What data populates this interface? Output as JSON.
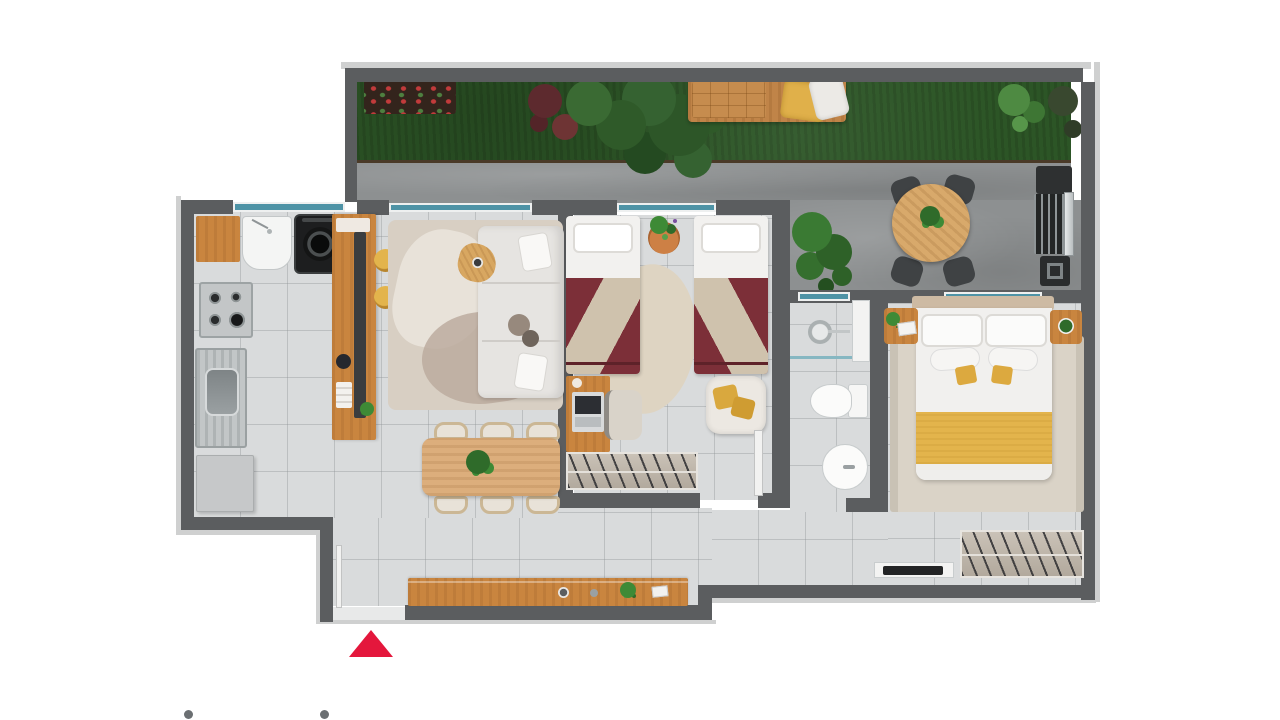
{
  "scene": {
    "type": "apartment-floor-plan-3d-render",
    "visible_text": [],
    "palette": {
      "background": "#ffffff",
      "wall": "#5b5d5f",
      "wall_trim": "#cfd0d0",
      "floor_tile": "#d9dbdc",
      "grass": "#2c5526",
      "concrete": "#8d9091",
      "window_glass": "#4e93a6",
      "wood": "#c9853f",
      "wood_light": "#dcae7c",
      "burgundy_bedding": "#7c2f38",
      "mustard_accent": "#e3b44c",
      "rug_beige": "#d8cfc3",
      "white_furniture": "#f2f1ef",
      "dark_appliance": "#232525",
      "steel": "#ccd0d1",
      "foliage_dark": "#2f5a29",
      "foliage_mid": "#3a6a33",
      "foliage_bright": "#4e8a42",
      "entrance_arrow_red": "#e4173c",
      "dot_gray": "#6b6f72"
    },
    "markers": {
      "entrance_arrow": {
        "shape": "triangle-up",
        "color": "#e4173c"
      },
      "pagination_dots": {
        "count": 2,
        "color": "#6b6f72"
      }
    },
    "rooms": [
      {
        "name": "garden",
        "items": [
          "flower-bed",
          "red-foliage",
          "tropical-plants",
          "daybed-bench",
          "yellow-throw",
          "pillows",
          "shrubs"
        ]
      },
      {
        "name": "terrace",
        "items": [
          "round-table",
          "chairs-x4",
          "table-plant",
          "potted-bush",
          "barbecue-grill"
        ]
      },
      {
        "name": "kitchen-laundry",
        "items": [
          "wall-shelf",
          "laundry-tub",
          "washing-machine",
          "cooktop",
          "sink-drainboard",
          "base-cabinet",
          "island-counter",
          "bar-stools-x2"
        ]
      },
      {
        "name": "living-dining",
        "items": [
          "area-rug",
          "sofa",
          "throw-pillows",
          "side-table",
          "dining-table",
          "dining-chairs-x6",
          "centerpiece-plant"
        ]
      },
      {
        "name": "twin-bedroom",
        "items": [
          "single-bed-left",
          "single-bed-right",
          "plant-pot",
          "oval-rug",
          "desk",
          "laptop",
          "desk-chair",
          "armchair",
          "wardrobe-rail",
          "door-leaf"
        ]
      },
      {
        "name": "bathroom",
        "items": [
          "shower-head",
          "glass-partition",
          "niche-shelf",
          "toilet",
          "washbasin"
        ]
      },
      {
        "name": "master-bedroom",
        "items": [
          "headboard",
          "double-bed",
          "yellow-blanket",
          "nightstand-left",
          "nightstand-right",
          "area-rug",
          "wardrobe-rail",
          "tv-console"
        ]
      },
      {
        "name": "entry-hall",
        "items": [
          "entry-door-leaf",
          "threshold",
          "sideboard",
          "decor-cup",
          "decor-plant",
          "decor-card"
        ]
      }
    ]
  }
}
